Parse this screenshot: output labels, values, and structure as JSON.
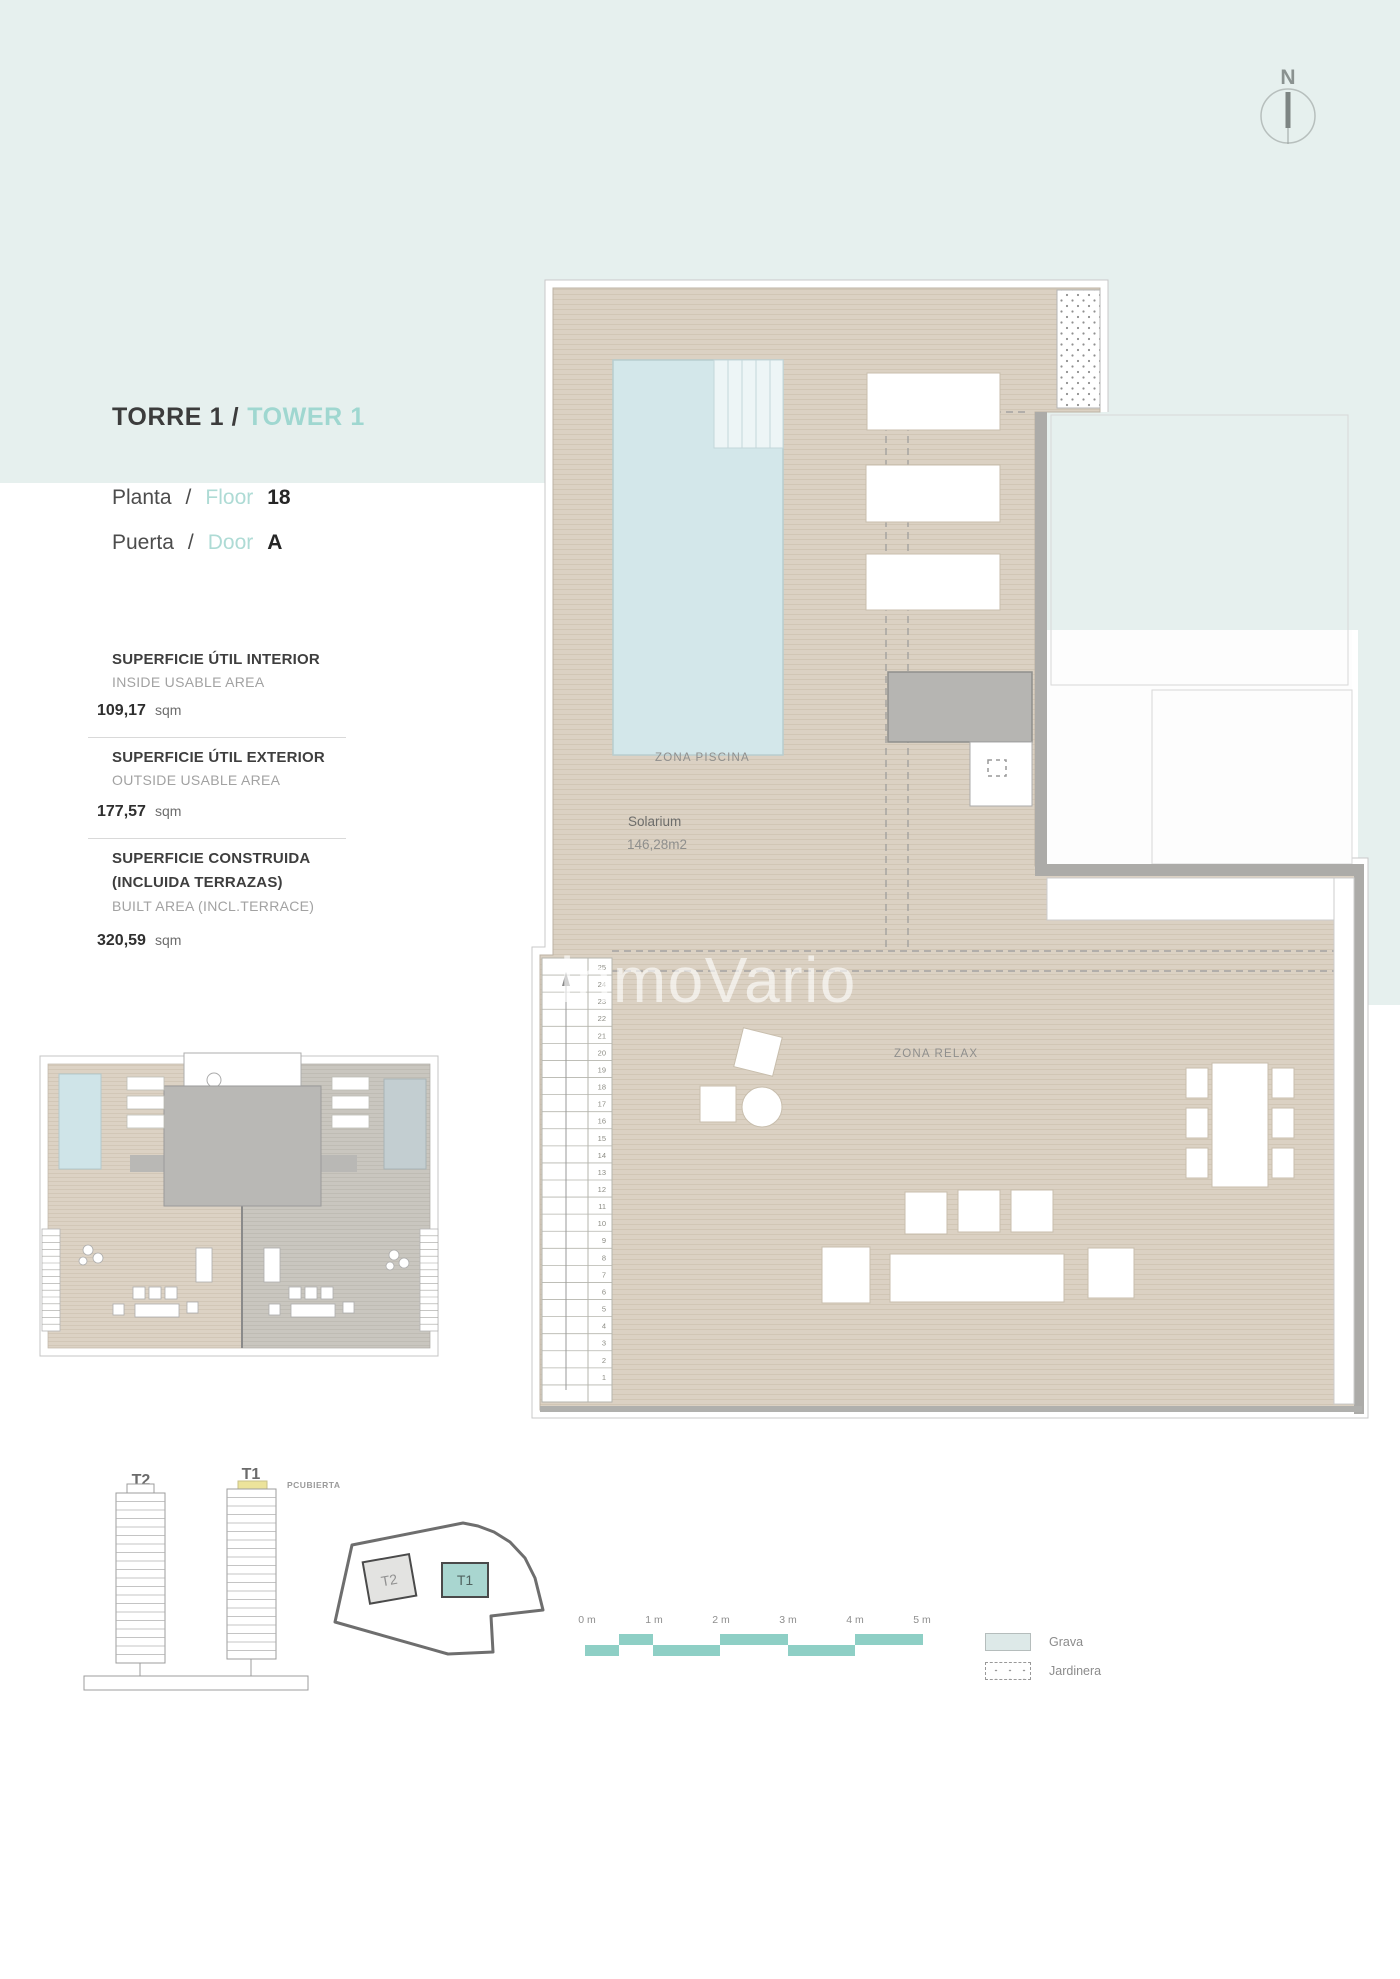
{
  "header": {
    "title_primary": "TORRE 1 /",
    "title_secondary": "TOWER 1",
    "floor_row": {
      "label_es": "Planta",
      "separator": "/",
      "label_en": "Floor",
      "value": "18"
    },
    "door_row": {
      "label_es": "Puerta",
      "separator": "/",
      "label_en": "Door",
      "value": "A"
    }
  },
  "area_summary": [
    {
      "title": "SUPERFICIE ÚTIL INTERIOR",
      "title2": "",
      "subtitle": "INSIDE USABLE AREA",
      "value": "109,17",
      "unit": "sqm"
    },
    {
      "title": "SUPERFICIE ÚTIL EXTERIOR",
      "title2": "",
      "subtitle": "OUTSIDE USABLE AREA",
      "value": "177,57",
      "unit": "sqm"
    },
    {
      "title": "SUPERFICIE CONSTRUIDA",
      "title2": "(INCLUIDA TERRAZAS)",
      "subtitle": "BUILT AREA (INCL.TERRACE)",
      "value": "320,59",
      "unit": "sqm"
    }
  ],
  "floor_plan": {
    "zona_piscina": "ZONA PISCINA",
    "solarium_label": "Solarium",
    "solarium_area": "146,28m2",
    "zona_relax": "ZONA RELAX",
    "stair_step_count": 25,
    "watermark": "inmoVario"
  },
  "compass": {
    "north_label": "N"
  },
  "tower_elevation": {
    "t2_label": "T2",
    "t1_label": "T1",
    "roof_label": "PCUBIERTA",
    "highlight_color": "#ece39b"
  },
  "site_plan": {
    "t2_label": "T2",
    "t1_label": "T1",
    "t1_color": "#a9d6d0"
  },
  "scale_bar": {
    "labels": [
      "0 m",
      "1 m",
      "2 m",
      "3 m",
      "4 m",
      "5 m"
    ],
    "color": "#8ecfc5"
  },
  "legend": {
    "items": [
      {
        "label": "Grava"
      },
      {
        "label": "Jardinera"
      }
    ]
  }
}
